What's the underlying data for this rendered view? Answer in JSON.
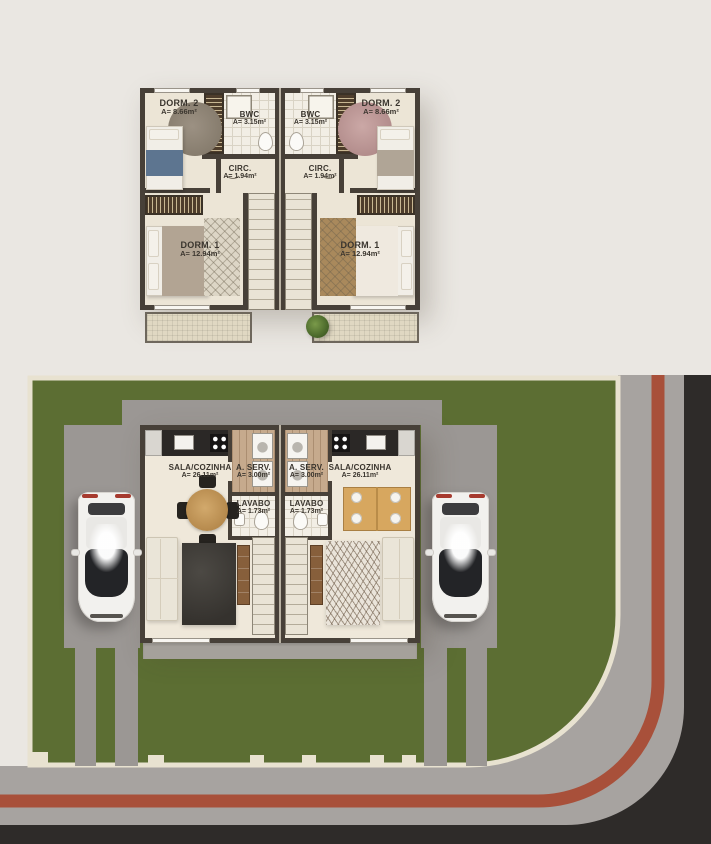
{
  "scene": {
    "type": "architectural-floor-plan-render",
    "description": "Duplex (two mirrored units): upper floor plan above, ground floor site plan below with two cars, lawn and corner street",
    "cars_visible": 2
  },
  "palette": {
    "background": "#eae7e2",
    "plan_wall": "#474038",
    "plan_floor": "#ece5d6",
    "wardrobe_hatch": "#4e3d2b",
    "lawn": "#5c6e33",
    "driveway_concrete": "#9b9794",
    "sidewalk": "#a7a3a0",
    "curb_stripe_red": "#a8503a",
    "asphalt": "#2e2b29",
    "boundary_wall_cream": "#e8e2d0",
    "label_text": "#3a352e",
    "car_body": "#f2f1ee"
  },
  "upper_floor": {
    "rooms": {
      "dorm2": {
        "name": "DORM. 2",
        "area": "A= 8.66m²"
      },
      "bwc": {
        "name": "BWC",
        "area": "A= 3.15m²"
      },
      "circ": {
        "name": "CIRC.",
        "area": "A= 1.94m²"
      },
      "dorm1": {
        "name": "DORM. 1",
        "area": "A= 12.94m²"
      }
    }
  },
  "ground_floor": {
    "rooms": {
      "sala": {
        "name": "SALA/COZINHA",
        "area": "A= 26.11m²"
      },
      "aserv": {
        "name": "A. SERV.",
        "area": "A= 3.00m²"
      },
      "lavabo": {
        "name": "LAVABO",
        "area": "A= 1.73m²"
      }
    }
  }
}
